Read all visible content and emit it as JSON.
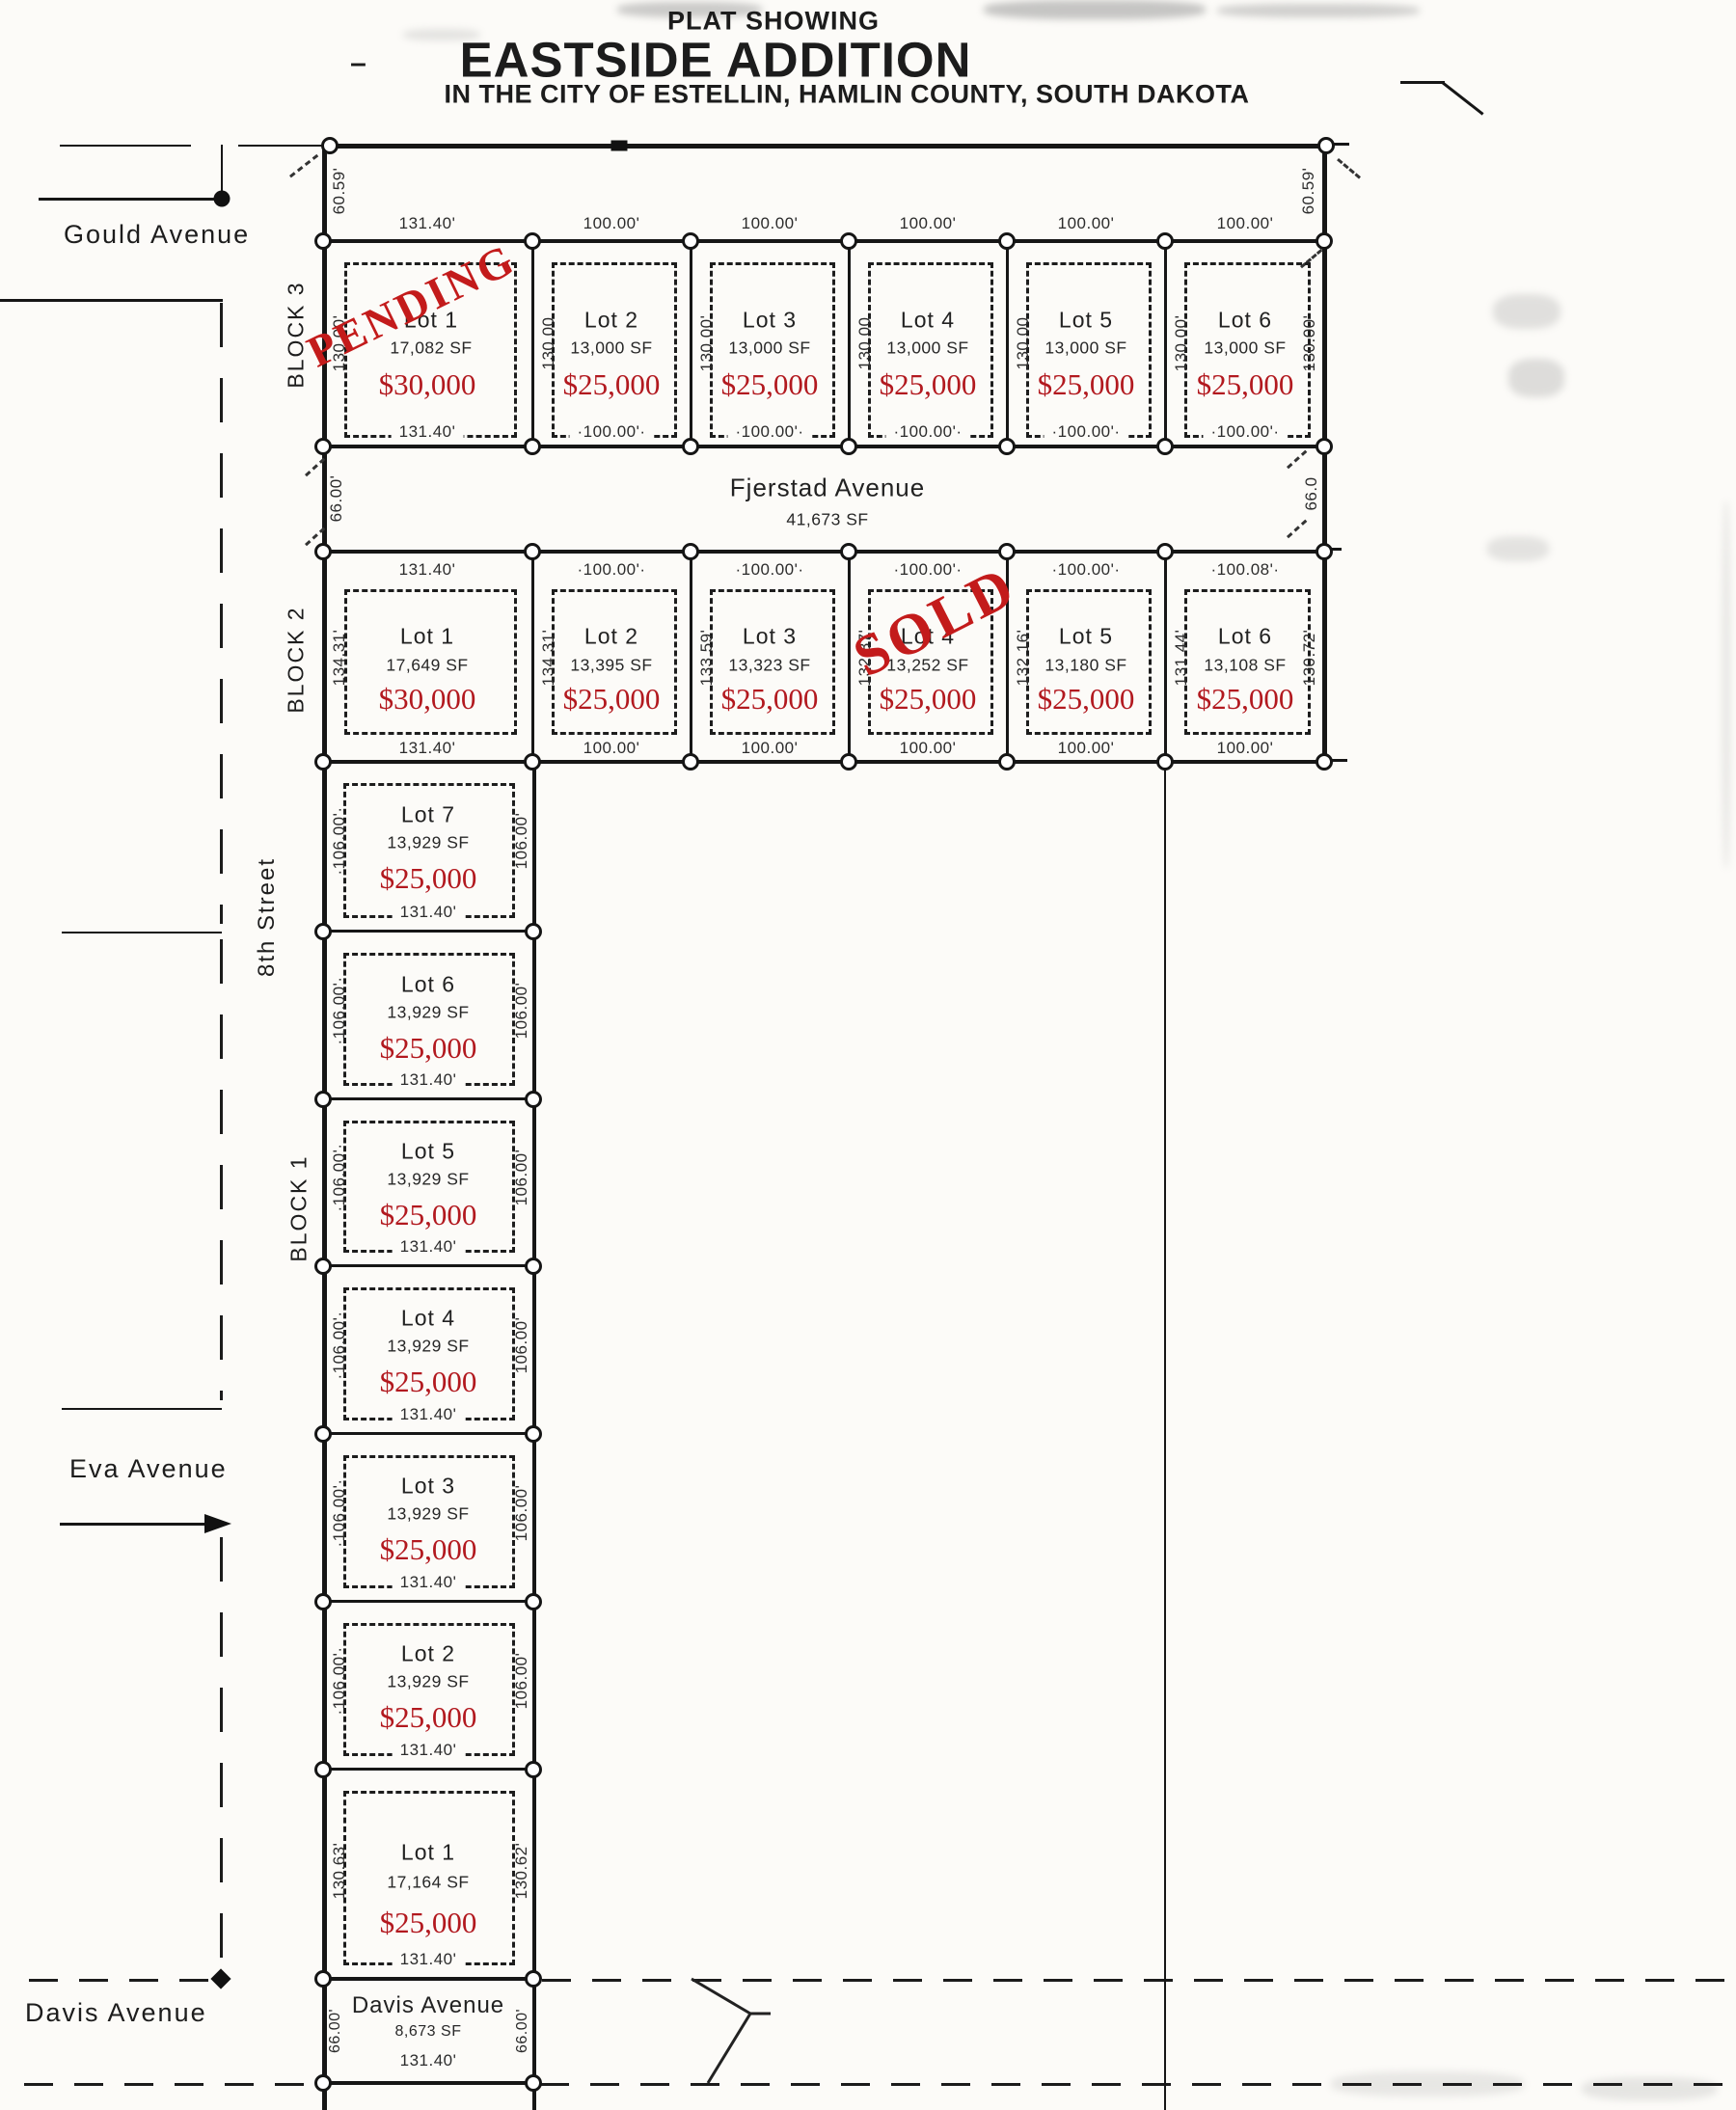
{
  "title": {
    "kicker": "PLAT SHOWING",
    "dash": "–",
    "name": "EASTSIDE ADDITION",
    "subtitle": "IN THE CITY OF ESTELLIN, HAMLIN COUNTY, SOUTH DAKOTA"
  },
  "streets": {
    "gould": "Gould Avenue",
    "eighth": "8th Street",
    "eva": "Eva Avenue",
    "davis": "Davis Avenue",
    "fjerstad": {
      "name": "Fjerstad Avenue",
      "sf": "41,673 SF",
      "west_width": "66.00'",
      "east_width": "66.0"
    },
    "davis_parcel": {
      "name": "Davis Avenue",
      "sf": "8,673 SF",
      "bottom": "131.40'",
      "west": "66.00'",
      "east": "66.00'"
    }
  },
  "corner_dims": {
    "nw": "60.59'",
    "ne": "60.59'"
  },
  "block3": {
    "label": "BLOCK 3",
    "east_side": "130.00'",
    "lots": [
      {
        "name": "Lot 1",
        "sf": "17,082 SF",
        "price": "$30,000",
        "top": "131.40'",
        "bottom": "131.40'",
        "side": "130.00'",
        "stamp": "PENDING"
      },
      {
        "name": "Lot 2",
        "sf": "13,000 SF",
        "price": "$25,000",
        "top": "100.00'",
        "bottom": "·100.00'·",
        "side": "130.00"
      },
      {
        "name": "Lot 3",
        "sf": "13,000 SF",
        "price": "$25,000",
        "top": "100.00'",
        "bottom": "·100.00'·",
        "side": "130.00'"
      },
      {
        "name": "Lot 4",
        "sf": "13,000 SF",
        "price": "$25,000",
        "top": "100.00'",
        "bottom": "·100.00'·",
        "side": "130.00"
      },
      {
        "name": "Lot 5",
        "sf": "13,000 SF",
        "price": "$25,000",
        "top": "100.00'",
        "bottom": "·100.00'·",
        "side": "130.00"
      },
      {
        "name": "Lot 6",
        "sf": "13,000 SF",
        "price": "$25,000",
        "top": "100.00'",
        "bottom": "·100.00'·",
        "side": "130.00'"
      }
    ]
  },
  "block2": {
    "label": "BLOCK 2",
    "east_side": "130.72'",
    "lots": [
      {
        "name": "Lot 1",
        "sf": "17,649 SF",
        "price": "$30,000",
        "top": "131.40'",
        "bottom": "131.40'",
        "side": "134.31'"
      },
      {
        "name": "Lot 2",
        "sf": "13,395 SF",
        "price": "$25,000",
        "top": "·100.00'·",
        "bottom": "100.00'",
        "side": "134.31'"
      },
      {
        "name": "Lot 3",
        "sf": "13,323 SF",
        "price": "$25,000",
        "top": "·100.00'·",
        "bottom": "100.00'",
        "side": "133.59'"
      },
      {
        "name": "Lot 4",
        "sf": "13,252 SF",
        "price": "$25,000",
        "top": "·100.00'·",
        "bottom": "100.00'",
        "side": "132.87'",
        "stamp": "SOLD"
      },
      {
        "name": "Lot 5",
        "sf": "13,180 SF",
        "price": "$25,000",
        "top": "·100.00'·",
        "bottom": "100.00'",
        "side": "132.16'"
      },
      {
        "name": "Lot 6",
        "sf": "13,108 SF",
        "price": "$25,000",
        "top": "·100.08'·",
        "bottom": "100.00'",
        "side": "131.44'"
      }
    ]
  },
  "block1": {
    "label": "BLOCK 1",
    "lots": [
      {
        "name": "Lot 7",
        "sf": "13,929 SF",
        "price": "$25,000",
        "west": "·106.00'·",
        "east": "106.00'",
        "bottom": "131.40'"
      },
      {
        "name": "Lot 6",
        "sf": "13,929 SF",
        "price": "$25,000",
        "west": "·106.00'·",
        "east": "106.00'",
        "bottom": "131.40'"
      },
      {
        "name": "Lot 5",
        "sf": "13,929 SF",
        "price": "$25,000",
        "west": "·106.00'·",
        "east": "106.00'",
        "bottom": "131.40'"
      },
      {
        "name": "Lot 4",
        "sf": "13,929 SF",
        "price": "$25,000",
        "west": "·106.00'·",
        "east": "106.00'",
        "bottom": "131.40'"
      },
      {
        "name": "Lot 3",
        "sf": "13,929 SF",
        "price": "$25,000",
        "west": "·106.00'·",
        "east": "106.00'",
        "bottom": "131.40'"
      },
      {
        "name": "Lot 2",
        "sf": "13,929 SF",
        "price": "$25,000",
        "west": "·106.00'·",
        "east": "106.00'",
        "bottom": "131.40'"
      },
      {
        "name": "Lot 1",
        "sf": "17,164 SF",
        "price": "$25,000",
        "west": "130.63'",
        "east": "130.62'",
        "bottom": "131.40'"
      }
    ]
  }
}
